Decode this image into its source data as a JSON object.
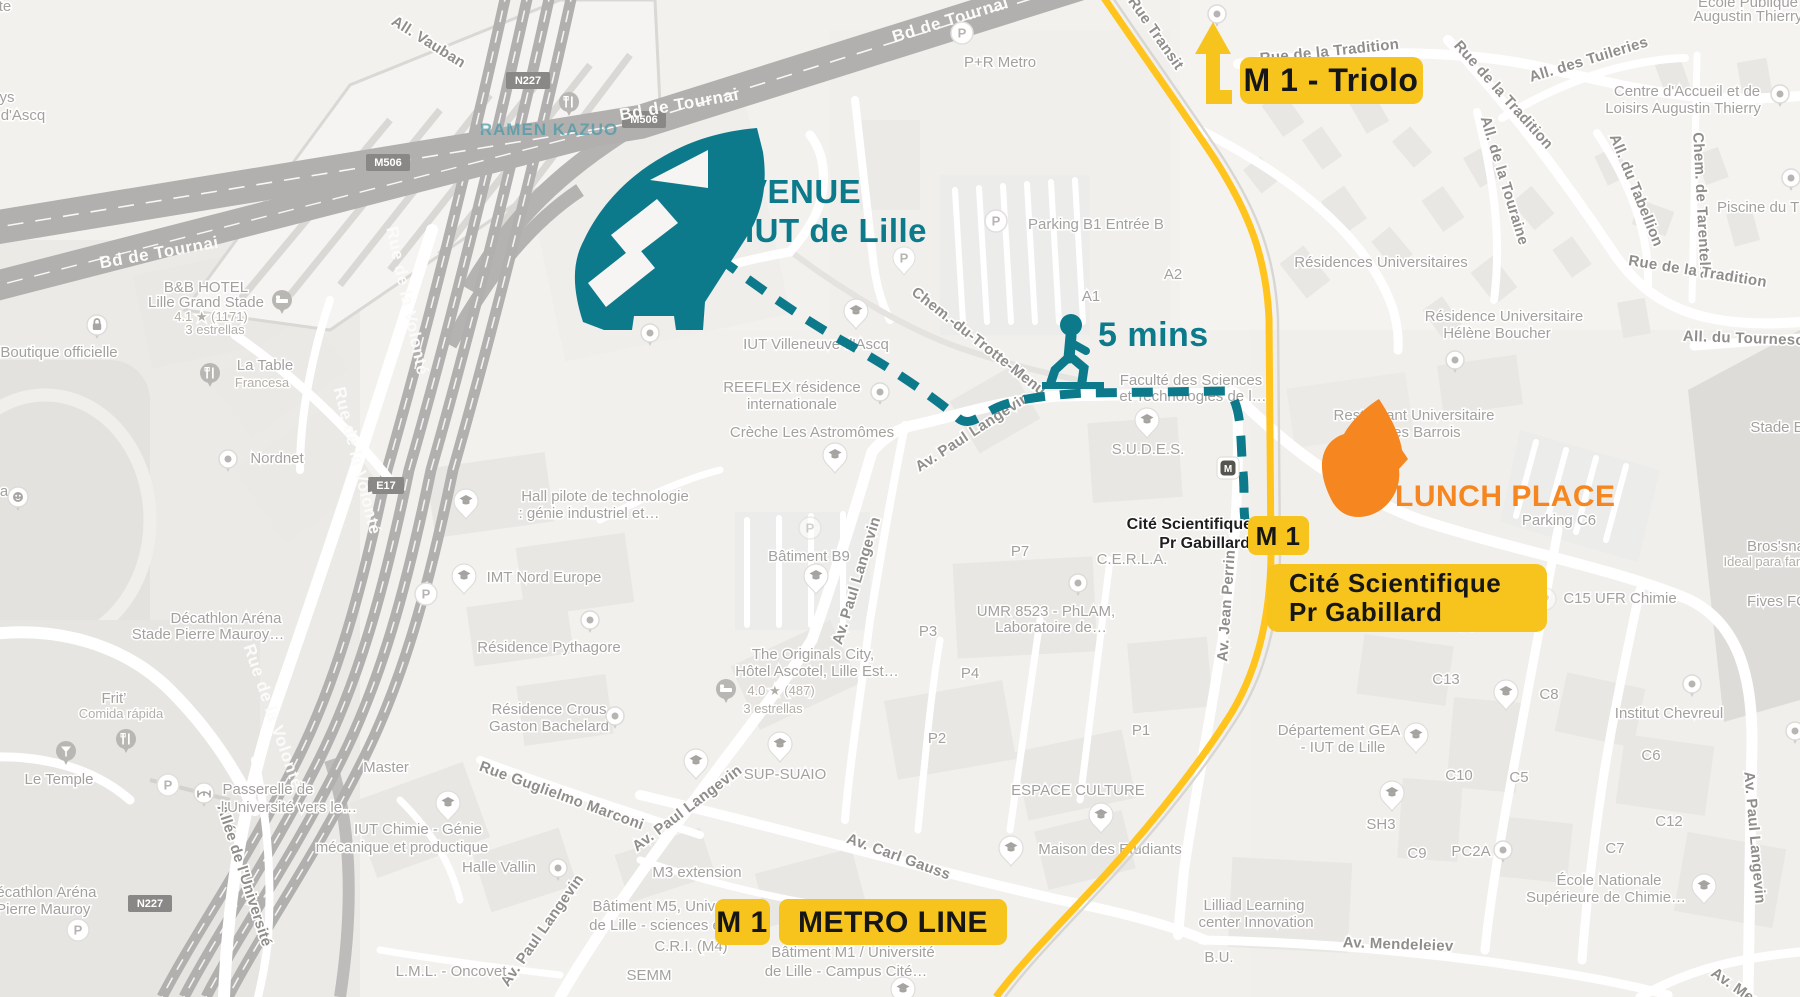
{
  "map": {
    "colors": {
      "venue_teal": "#0D7A8C",
      "metro_line_yellow": "#FFC41D",
      "badge_yellow": "#F6C41D",
      "lunch_orange": "#F6861F",
      "map_background": "#F2F1EE"
    },
    "annotations": {
      "venue_line1": "VENUE",
      "venue_line2": "IUT de Lille",
      "walk_time": "5 mins",
      "lunch_place": "LUNCH PLACE",
      "triolo_badge": "M 1 - Triolo",
      "station_badge": "M 1",
      "station_name_line1": "Cité Scientifique",
      "station_name_line2": "Pr Gabillard",
      "line_badge_m": "M 1",
      "line_badge_label": "METRO LINE"
    },
    "station_map_label": [
      "Cité Scientifique",
      "Pr Gabillard"
    ],
    "road_shields": [
      "M506",
      "M506",
      "N227",
      "N227",
      "E17"
    ],
    "icons": {
      "parking_glyph": "P",
      "metro_glyph": "M"
    },
    "street_labels": [
      "All. Vauban",
      "Rue Transit",
      "Rue de la Tradition",
      "Rue de la Tradition",
      "All. des Tuileries",
      "All. de la Touraine",
      "All. du Tabellion",
      "Chem. de Tarentelle",
      "Rue de la Tradition",
      "All. du Tournesol",
      "Chem.-du-Trotte-Menu",
      "Av. Paul Langevin",
      "Av. Paul Langevin",
      "Av. Paul Langevin",
      "Av. Paul Langevin",
      "Av. Paul Langevin",
      "Av. Jean Perrin",
      "Av. Carl Gauss",
      "Av. Mendeleiev",
      "Av. Mendeleiev",
      "Rue Guglielmo Marconi",
      "Allée de l'Université",
      "Rue de la Volonté",
      "Rue de la Volonté",
      "Rue de la Volonté",
      "Bd de Tournai",
      "Bd de Tournai",
      "Bd de Tournai"
    ],
    "poi_labels": [
      "P+R Metro",
      "Parking B1 Entrée B",
      "A1",
      "A2",
      "IUT Villeneuve d'Ascq",
      "REEFLEX résidence",
      "internationale",
      "Crèche Les Astromômes",
      "Faculté des Sciences",
      "et Technologies de l…",
      "S.U.D.E.S.",
      "Résidences Universitaires",
      "Résidence Universitaire",
      "Hélène Boucher",
      "Restaurant Universitaire",
      "Charles Barrois",
      "Parking C6",
      "C15 UFR Chimie",
      "Bros'sna",
      "Ideal para famil",
      "Fives FC",
      "Stade E",
      "C.E.R.L.A.",
      "UMR 8523 - PhLAM,",
      "Laboratoire de…",
      "P7",
      "P3",
      "P4",
      "P2",
      "P1",
      "ESPACE CULTURE",
      "Maison des Etudiants",
      "The Originals City,",
      "Hôtel Ascotel, Lille Est…",
      "4.0 ★ (487)",
      "3 estrellas",
      "SUP-SUAIO",
      "M3 extension",
      "Bâtiment M5, Unive",
      "de Lille - sciences e",
      "C.R.I. (M4)",
      "SEMM",
      "Bâtiment M1 / Université",
      "de Lille - Campus Cité…",
      "Bâtiment B9",
      "Hall pilote de technologie",
      ": génie industriel et…",
      "IMT Nord Europe",
      "Résidence Pythagore",
      "Résidence Crous",
      "Gaston Bachelard",
      "Master",
      "IUT Chimie - Génie",
      "mécanique et productique",
      "Halle Vallin",
      "L.M.L. - Oncovet",
      "Passerelle de",
      "l'Université vers le…",
      "Le Temple",
      "Frit’",
      "Comida rápida",
      "Décathlon Aréna",
      "Stade Pierre Mauroy…",
      "Décathlon Aréna",
      "e Pierre Mauroy",
      "Nordnet",
      "La Table",
      "Francesa",
      "Boutique officielle",
      "B&B HOTEL",
      "Lille Grand Stade",
      "4.1 ★ (1171)",
      "3 estrellas",
      "ys",
      "d'Ascq",
      "te",
      "a",
      "RAMEN KAZUO",
      "Lilliad Learning",
      "center Innovation",
      "B.U.",
      "Département GEA",
      "- IUT de Lille",
      "Institut Chevreul",
      "C8",
      "C13",
      "C6",
      "C10",
      "C5",
      "SH3",
      "C12",
      "C9",
      "PC2A",
      "C7",
      "École Nationale",
      "Supérieure de Chimie…",
      "C3",
      "C4",
      "Piscine du T",
      "Centre d'Accueil et de",
      "Loisirs Augustin Thierry",
      "École Publique",
      "Augustin Thierry"
    ]
  }
}
